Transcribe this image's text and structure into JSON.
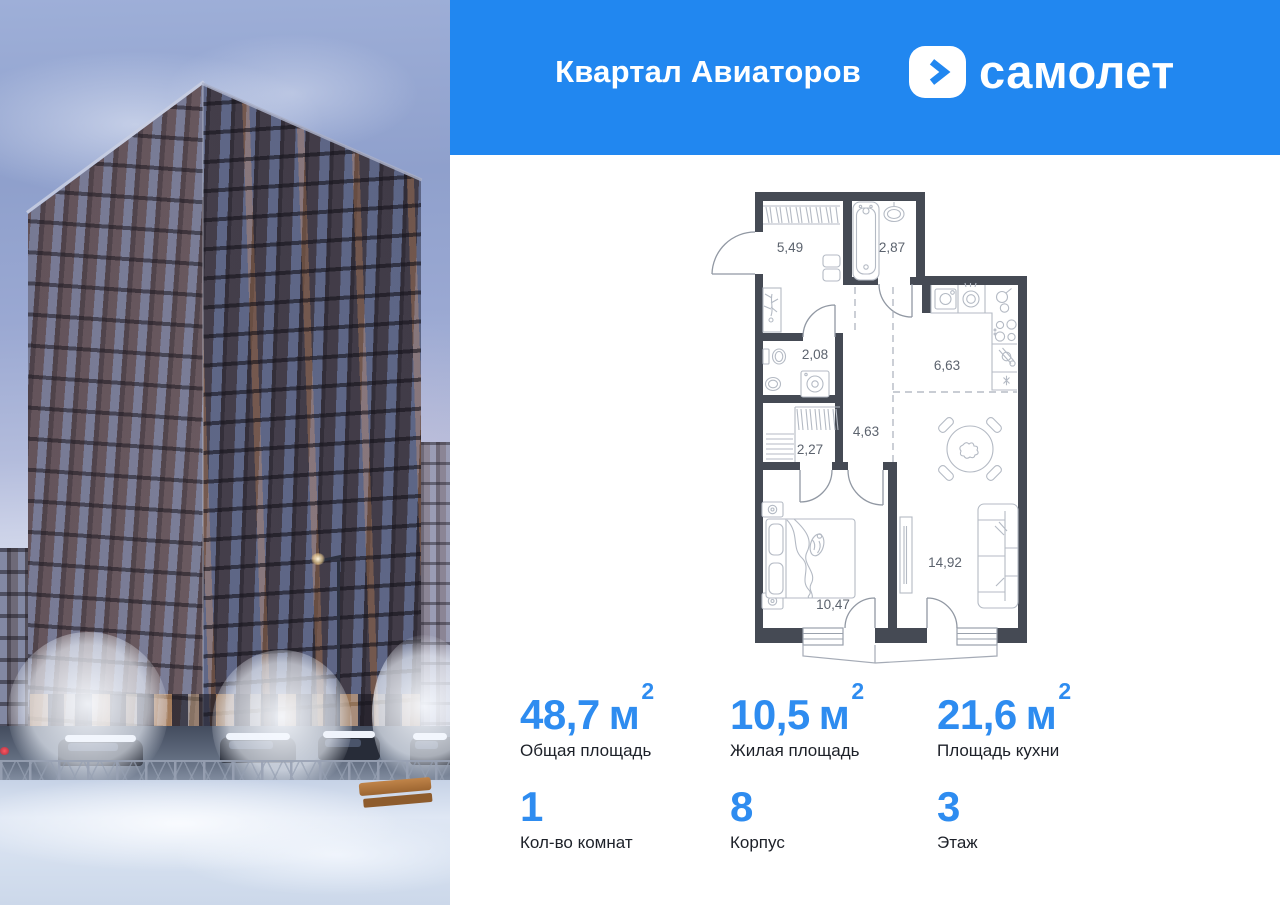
{
  "header": {
    "project_name": "Квартал Авиаторов",
    "brand_name": "самолет"
  },
  "floor_plan": {
    "rooms": [
      {
        "name": "hallway",
        "area": "5,49"
      },
      {
        "name": "bathroom",
        "area": "2,87"
      },
      {
        "name": "wc",
        "area": "2,08"
      },
      {
        "name": "kitchen",
        "area": "6,63"
      },
      {
        "name": "corridor",
        "area": "4,63"
      },
      {
        "name": "wardrobe",
        "area": "2,27"
      },
      {
        "name": "bedroom",
        "area": "10,47"
      },
      {
        "name": "living-room",
        "area": "14,92"
      }
    ]
  },
  "stats": {
    "primary": [
      {
        "value": "48,7",
        "unit": "м",
        "unit_sup": "2",
        "label": "Общая площадь"
      },
      {
        "value": "10,5",
        "unit": "м",
        "unit_sup": "2",
        "label": "Жилая площадь"
      },
      {
        "value": "21,6",
        "unit": "м",
        "unit_sup": "2",
        "label": "Площадь кухни"
      }
    ],
    "secondary": [
      {
        "value": "1",
        "label": "Кол-во комнат"
      },
      {
        "value": "8",
        "label": "Корпус"
      },
      {
        "value": "3",
        "label": "Этаж"
      }
    ]
  },
  "colors": {
    "brand_blue": "#2187f0",
    "stat_blue": "#2e8cf0",
    "wall_dark": "#454a54"
  }
}
